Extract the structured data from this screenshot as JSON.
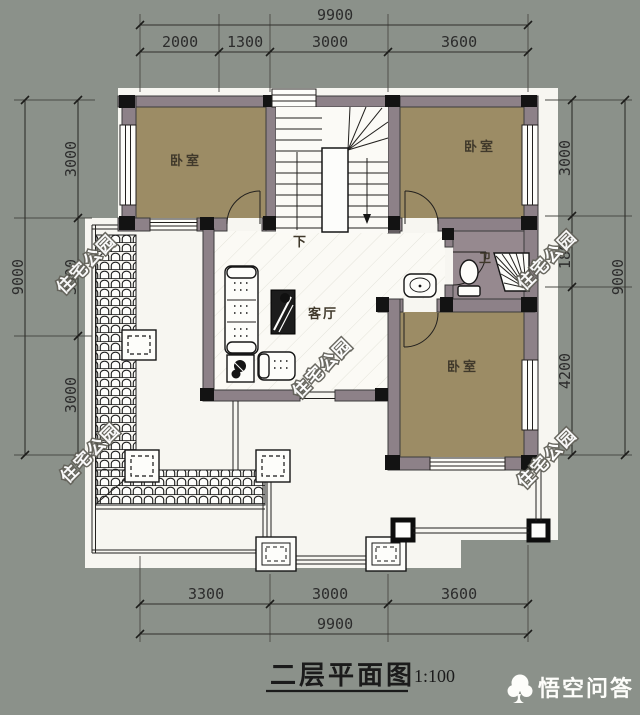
{
  "colors": {
    "background": "#8b918a",
    "paper": "#f7f6f1",
    "wall": "#8d8188",
    "bedroom_floor": "#9c8c65",
    "bath_floor": "#96898f",
    "line": "#2c2c2c"
  },
  "dims": {
    "top": {
      "overall": "9900",
      "seg": [
        "2000",
        "1300",
        "3000",
        "3600"
      ]
    },
    "bottom": {
      "overall": "9900",
      "seg": [
        "3300",
        "3000",
        "3600"
      ]
    },
    "left": {
      "overall": "9000",
      "seg": [
        "3000",
        "3000",
        "3000"
      ]
    },
    "right": {
      "overall": "9000",
      "seg": [
        "3000",
        "1800",
        "4200"
      ]
    }
  },
  "labels": {
    "bedroom": "卧室",
    "living": "客厅",
    "bath": "卫",
    "down": "下"
  },
  "watermark": {
    "text": "住宅公园"
  },
  "titleblock": {
    "title": "二层平面图",
    "scale": "1:100"
  },
  "logo": {
    "text": "悟空问答"
  }
}
